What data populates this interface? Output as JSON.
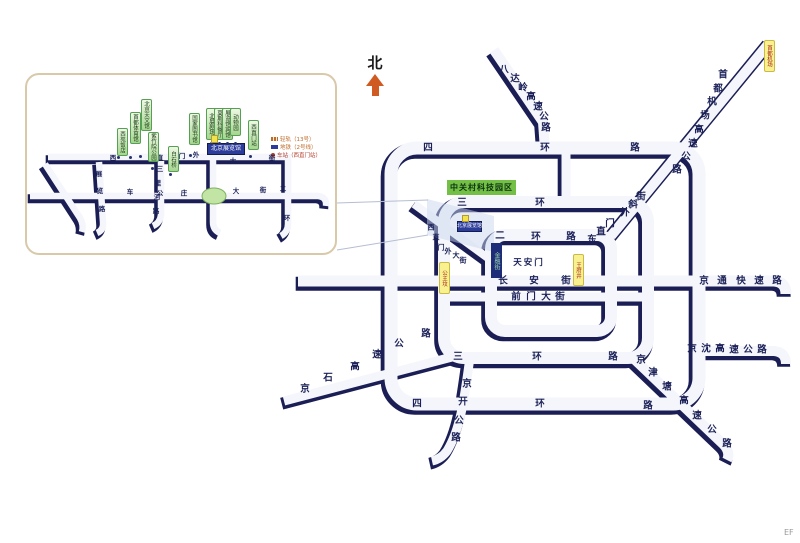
{
  "map": {
    "north_label": "北",
    "watermark": "EF",
    "park_label": "中关村科技园区",
    "financial_label": "金融街",
    "venue_box": {
      "text": "北京展览馆"
    },
    "area_labels": [
      {
        "text": "天安门",
        "x": 529,
        "y": 263
      }
    ],
    "chars": [
      {
        "t": "四",
        "x": 428,
        "y": 148
      },
      {
        "t": "环",
        "x": 545,
        "y": 148
      },
      {
        "t": "路",
        "x": 635,
        "y": 148
      },
      {
        "t": "三",
        "x": 462,
        "y": 203
      },
      {
        "t": "环",
        "x": 540,
        "y": 203
      },
      {
        "t": "二",
        "x": 500,
        "y": 236
      },
      {
        "t": "环",
        "x": 536,
        "y": 237
      },
      {
        "t": "路",
        "x": 571,
        "y": 237
      },
      {
        "t": "三",
        "x": 458,
        "y": 357
      },
      {
        "t": "环",
        "x": 537,
        "y": 357
      },
      {
        "t": "路",
        "x": 613,
        "y": 357
      },
      {
        "t": "四",
        "x": 417,
        "y": 404
      },
      {
        "t": "环",
        "x": 540,
        "y": 404
      },
      {
        "t": "路",
        "x": 648,
        "y": 406
      },
      {
        "t": "京",
        "x": 467,
        "y": 384
      },
      {
        "t": "开",
        "x": 463,
        "y": 402
      },
      {
        "t": "公",
        "x": 459,
        "y": 421
      },
      {
        "t": "路",
        "x": 456,
        "y": 438
      },
      {
        "t": "八",
        "x": 504,
        "y": 70
      },
      {
        "t": "达",
        "x": 515,
        "y": 79
      },
      {
        "t": "岭",
        "x": 523,
        "y": 88
      },
      {
        "t": "高",
        "x": 531,
        "y": 97
      },
      {
        "t": "速",
        "x": 538,
        "y": 107
      },
      {
        "t": "公",
        "x": 544,
        "y": 117
      },
      {
        "t": "路",
        "x": 546,
        "y": 128
      },
      {
        "t": "首",
        "x": 723,
        "y": 75
      },
      {
        "t": "都",
        "x": 718,
        "y": 89
      },
      {
        "t": "机",
        "x": 712,
        "y": 102
      },
      {
        "t": "场",
        "x": 705,
        "y": 116
      },
      {
        "t": "高",
        "x": 699,
        "y": 130
      },
      {
        "t": "速",
        "x": 693,
        "y": 144
      },
      {
        "t": "公",
        "x": 686,
        "y": 157
      },
      {
        "t": "路",
        "x": 677,
        "y": 170
      },
      {
        "t": "东",
        "x": 592,
        "y": 240
      },
      {
        "t": "直",
        "x": 601,
        "y": 232
      },
      {
        "t": "门",
        "x": 610,
        "y": 224
      },
      {
        "t": "外",
        "x": 625,
        "y": 213
      },
      {
        "t": "斜",
        "x": 633,
        "y": 205
      },
      {
        "t": "街",
        "x": 641,
        "y": 197
      },
      {
        "t": "长",
        "x": 503,
        "y": 281
      },
      {
        "t": "安",
        "x": 534,
        "y": 281
      },
      {
        "t": "街",
        "x": 566,
        "y": 281
      },
      {
        "t": "前",
        "x": 516,
        "y": 297
      },
      {
        "t": "门",
        "x": 531,
        "y": 297
      },
      {
        "t": "大",
        "x": 546,
        "y": 297
      },
      {
        "t": "街",
        "x": 560,
        "y": 297
      },
      {
        "t": "京",
        "x": 704,
        "y": 281
      },
      {
        "t": "通",
        "x": 722,
        "y": 281
      },
      {
        "t": "快",
        "x": 741,
        "y": 281
      },
      {
        "t": "速",
        "x": 759,
        "y": 281
      },
      {
        "t": "路",
        "x": 777,
        "y": 281
      },
      {
        "t": "京",
        "x": 692,
        "y": 349
      },
      {
        "t": "沈",
        "x": 706,
        "y": 349
      },
      {
        "t": "高",
        "x": 720,
        "y": 349
      },
      {
        "t": "速",
        "x": 734,
        "y": 350
      },
      {
        "t": "公",
        "x": 748,
        "y": 350
      },
      {
        "t": "路",
        "x": 762,
        "y": 350
      },
      {
        "t": "京",
        "x": 641,
        "y": 360
      },
      {
        "t": "津",
        "x": 653,
        "y": 373
      },
      {
        "t": "塘",
        "x": 667,
        "y": 387
      },
      {
        "t": "高",
        "x": 684,
        "y": 401
      },
      {
        "t": "速",
        "x": 697,
        "y": 416
      },
      {
        "t": "公",
        "x": 712,
        "y": 430
      },
      {
        "t": "路",
        "x": 727,
        "y": 444
      },
      {
        "t": "京",
        "x": 305,
        "y": 389
      },
      {
        "t": "石",
        "x": 328,
        "y": 378
      },
      {
        "t": "高",
        "x": 355,
        "y": 367
      },
      {
        "t": "速",
        "x": 377,
        "y": 355
      },
      {
        "t": "公",
        "x": 399,
        "y": 344
      },
      {
        "t": "路",
        "x": 426,
        "y": 334
      }
    ],
    "small_chars": [
      {
        "t": "西",
        "x": 431,
        "y": 228
      },
      {
        "t": "直",
        "x": 436,
        "y": 238
      },
      {
        "t": "门",
        "x": 441,
        "y": 248
      },
      {
        "t": "外",
        "x": 448,
        "y": 252
      },
      {
        "t": "大",
        "x": 456,
        "y": 256
      },
      {
        "t": "街",
        "x": 463,
        "y": 261
      }
    ],
    "station_tags": [
      {
        "text": "首都机场",
        "x": 768,
        "y": 40,
        "h": 30
      },
      {
        "text": "公主坟",
        "x": 443,
        "y": 262,
        "h": 30
      },
      {
        "text": "王府井",
        "x": 577,
        "y": 254,
        "h": 30
      }
    ],
    "markers": [
      {
        "x": 462,
        "y": 215,
        "w": 5,
        "h": 5
      },
      {
        "x": 211,
        "y": 135,
        "w": 5,
        "h": 6
      }
    ]
  },
  "inset": {
    "venue_box": {
      "text": "北京展览馆"
    },
    "chars": [
      {
        "t": "西",
        "x": 113,
        "y": 158
      },
      {
        "t": "直",
        "x": 160,
        "y": 158
      },
      {
        "t": "门",
        "x": 182,
        "y": 156
      },
      {
        "t": "外",
        "x": 196,
        "y": 155
      },
      {
        "t": "大",
        "x": 233,
        "y": 161
      },
      {
        "t": "街",
        "x": 272,
        "y": 158
      },
      {
        "t": "车",
        "x": 130,
        "y": 192
      },
      {
        "t": "公",
        "x": 160,
        "y": 193
      },
      {
        "t": "庄",
        "x": 184,
        "y": 193
      },
      {
        "t": "大",
        "x": 236,
        "y": 191
      },
      {
        "t": "街",
        "x": 263,
        "y": 190
      },
      {
        "t": "二",
        "x": 283,
        "y": 189
      },
      {
        "t": "环",
        "x": 287,
        "y": 218
      },
      {
        "t": "三",
        "x": 160,
        "y": 169
      },
      {
        "t": "里",
        "x": 158,
        "y": 183
      },
      {
        "t": "河",
        "x": 157,
        "y": 197
      },
      {
        "t": "路",
        "x": 156,
        "y": 211
      },
      {
        "t": "展",
        "x": 99,
        "y": 174
      },
      {
        "t": "览",
        "x": 100,
        "y": 191
      },
      {
        "t": "路",
        "x": 102,
        "y": 209
      }
    ],
    "poi_tags": [
      {
        "text": "西苑饭店",
        "x": 121,
        "y": 128,
        "h": 26,
        "dx": 118,
        "dy": 157
      },
      {
        "text": "首都体育馆",
        "x": 134,
        "y": 112,
        "h": 30,
        "dx": 130,
        "dy": 157
      },
      {
        "text": "北京天文馆",
        "x": 145,
        "y": 99,
        "h": 30,
        "dx": 140,
        "dy": 156
      },
      {
        "text": "紫竹院公园",
        "x": 152,
        "y": 132,
        "h": 28,
        "dx": 152,
        "dy": 168
      },
      {
        "text": "白石桥",
        "x": 172,
        "y": 146,
        "h": 24,
        "dx": 170,
        "dy": 174
      },
      {
        "text": "国家图书馆",
        "x": 193,
        "y": 113,
        "h": 30,
        "dx": 190,
        "dy": 155
      },
      {
        "text": "北展剧场",
        "x": 210,
        "y": 108,
        "h": 30,
        "dx": 211,
        "dy": 143
      },
      {
        "text": "莫斯科餐厅",
        "x": 218,
        "y": 108,
        "h": 30,
        "dx": 219,
        "dy": 143
      },
      {
        "text": "展览馆宾馆",
        "x": 226,
        "y": 108,
        "h": 30,
        "dx": 227,
        "dy": 143
      },
      {
        "text": "动物园",
        "x": 234,
        "y": 108,
        "h": 26,
        "dx": 235,
        "dy": 143
      },
      {
        "text": "西直门站",
        "x": 252,
        "y": 120,
        "h": 28,
        "dx": 250,
        "dy": 156
      }
    ],
    "legend": [
      {
        "symbol": "rail",
        "text": "轻轨（13号）"
      },
      {
        "symbol": "metro",
        "text": "地铁（2号线）"
      },
      {
        "symbol": "station",
        "text": "车站（西直门站）"
      }
    ]
  },
  "colors": {
    "road_edge": "#1a1e55",
    "road_fill": "#f5f6fb",
    "park_green": "#74bf45",
    "venue_blue": "#2b3c9a",
    "station_yellow": "#f9f18f",
    "north_orange": "#cf5b22"
  }
}
